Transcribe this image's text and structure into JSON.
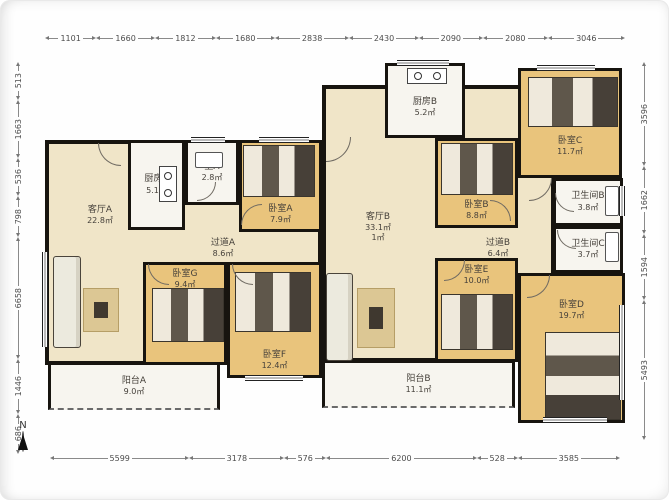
{
  "compass": {
    "label": "N"
  },
  "colors": {
    "wall": "#17140f",
    "living": "#f0e5c8",
    "bedroom": "#e9c47c",
    "wet_room": "#f7f5ef",
    "dim_text": "#4c4c4c"
  },
  "dimensions": {
    "top": [
      1101,
      1660,
      1812,
      1680,
      2838,
      2430,
      2090,
      2080,
      3046
    ],
    "bottom": [
      5599,
      3178,
      576,
      6200,
      528,
      3585
    ],
    "left": [
      513,
      1663,
      536,
      798,
      6658,
      1446,
      686
    ],
    "right": [
      3596,
      1662,
      1594,
      5493
    ]
  },
  "rooms": {
    "living_a": {
      "name": "客厅A",
      "area": "22.8㎡"
    },
    "kitchen_a": {
      "name": "厨房A",
      "area": "5.1㎡"
    },
    "bath_a": {
      "name": "卫A",
      "area": "2.8㎡"
    },
    "bedroom_a": {
      "name": "卧室A",
      "area": "7.9㎡"
    },
    "hall_a": {
      "name": "过道A",
      "area": "8.6㎡"
    },
    "bedroom_g": {
      "name": "卧室G",
      "area": "9.4㎡"
    },
    "bedroom_f": {
      "name": "卧室F",
      "area": "12.4㎡"
    },
    "balcony_a": {
      "name": "阳台A",
      "area": "9.0㎡"
    },
    "living_b": {
      "name": "客厅B",
      "area": "33.1㎡",
      "area2": "1㎡"
    },
    "kitchen_b": {
      "name": "厨房B",
      "area": "5.2㎡"
    },
    "bedroom_b": {
      "name": "卧室B",
      "area": "8.8㎡"
    },
    "bedroom_c": {
      "name": "卧室C",
      "area": "11.7㎡"
    },
    "bath_b": {
      "name": "卫生间B",
      "area": "3.8㎡"
    },
    "bath_c": {
      "name": "卫生间C",
      "area": "3.7㎡"
    },
    "hall_b": {
      "name": "过道B",
      "area": "6.4㎡"
    },
    "bedroom_e": {
      "name": "卧室E",
      "area": "10.0㎡"
    },
    "bedroom_d": {
      "name": "卧室D",
      "area": "19.7㎡"
    },
    "balcony_b": {
      "name": "阳台B",
      "area": "11.1㎡"
    }
  }
}
